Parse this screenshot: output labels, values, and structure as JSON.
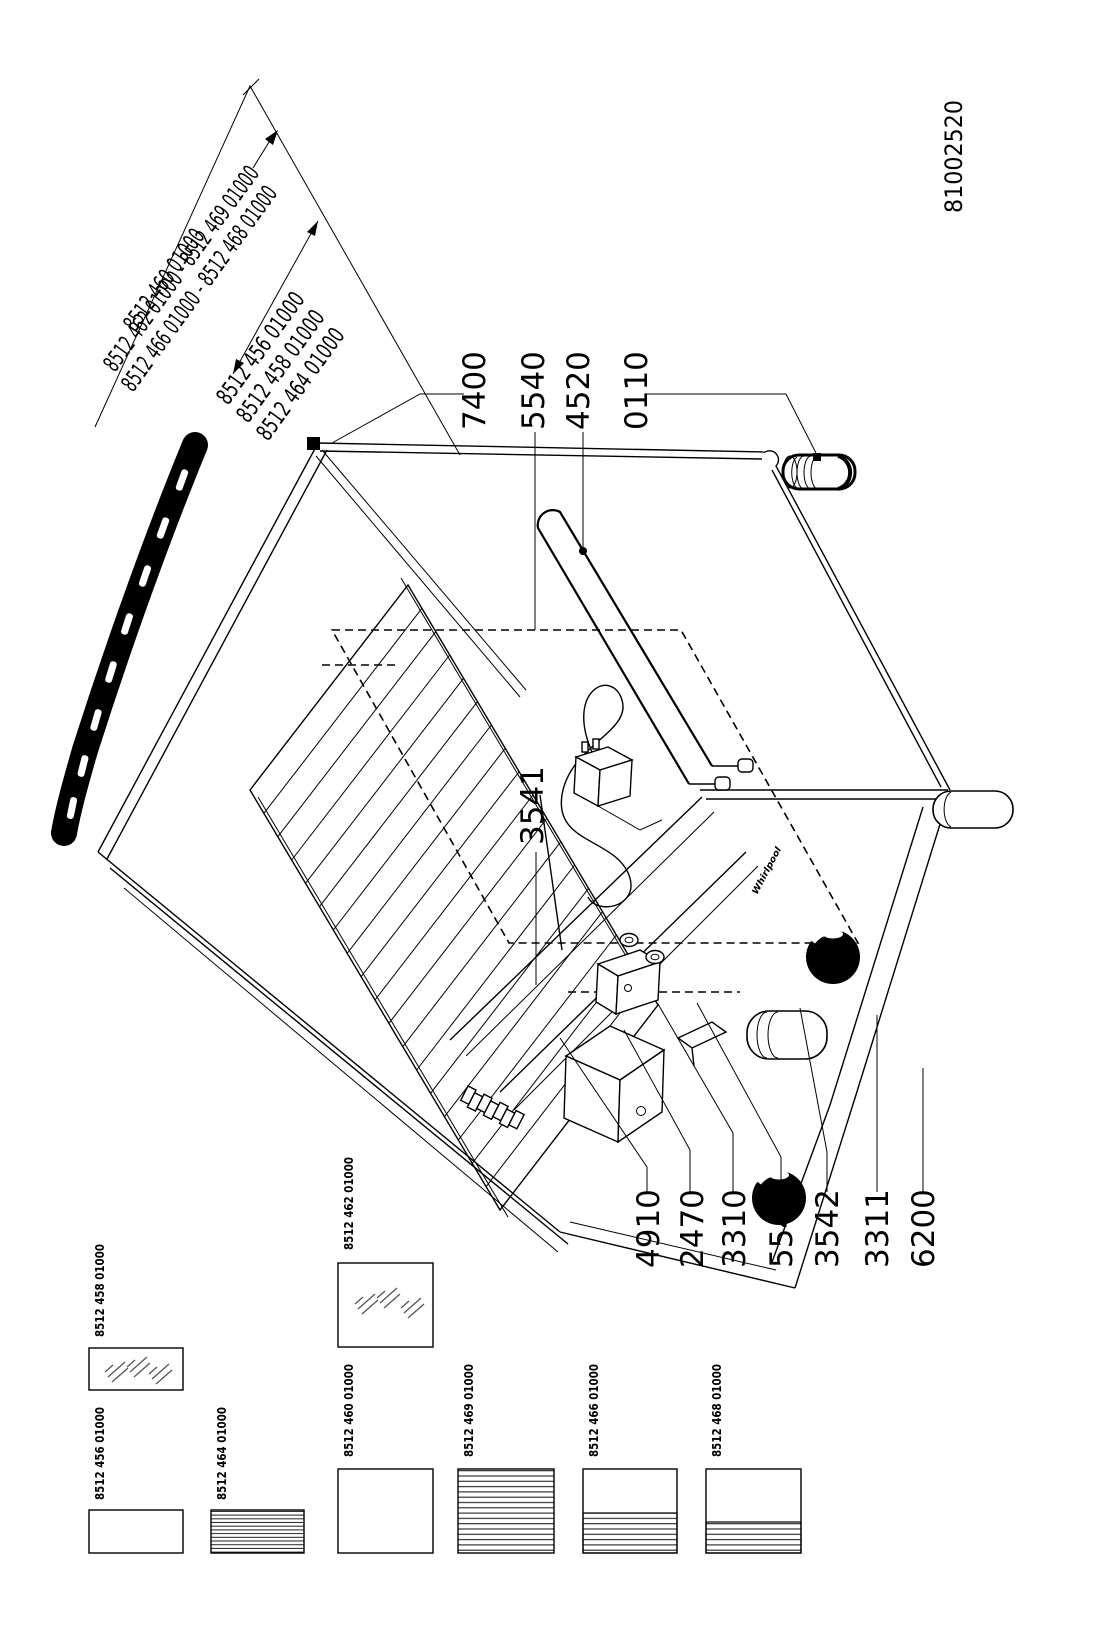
{
  "doc_number": "81002520",
  "brand": "Whirlpool",
  "variant_labels": {
    "group1": {
      "line1": "8512 460 01000",
      "line2": "8512 462 01000 - 8512 469 01000",
      "line3": "8512 466 01000 - 8512 468 01000"
    },
    "group2": {
      "line1": "8512 456 01000",
      "line2": "8512 458 01000",
      "line3": "8512 464 01000"
    }
  },
  "callouts": {
    "top": [
      {
        "id": "7400"
      },
      {
        "id": "5540"
      },
      {
        "id": "4520"
      },
      {
        "id": "0110"
      }
    ],
    "middle": [
      {
        "id": "3541"
      }
    ],
    "bottom": [
      {
        "id": "4910"
      },
      {
        "id": "2470"
      },
      {
        "id": "3310"
      },
      {
        "id": "5541"
      },
      {
        "id": "3542"
      },
      {
        "id": "3311"
      },
      {
        "id": "6200"
      }
    ]
  },
  "thumbnails": [
    {
      "label": "8512 458 01000",
      "pattern": "glass"
    },
    {
      "label": "8512 456 01000",
      "pattern": "plain"
    },
    {
      "label": "8512 464 01000",
      "pattern": "lines-full"
    },
    {
      "label": "8512 462 01000",
      "pattern": "glass"
    },
    {
      "label": "8512 460 01000",
      "pattern": "plain"
    },
    {
      "label": "8512 469 01000",
      "pattern": "lines-full"
    },
    {
      "label": "8512 466 01000",
      "pattern": "lines-bottom-half"
    },
    {
      "label": "8512 463 01000_unused",
      "pattern": ""
    },
    {
      "label": "8512 468 01000",
      "pattern": "lines-bottom-third"
    }
  ],
  "colors": {
    "line": "#000000",
    "background": "#ffffff"
  }
}
